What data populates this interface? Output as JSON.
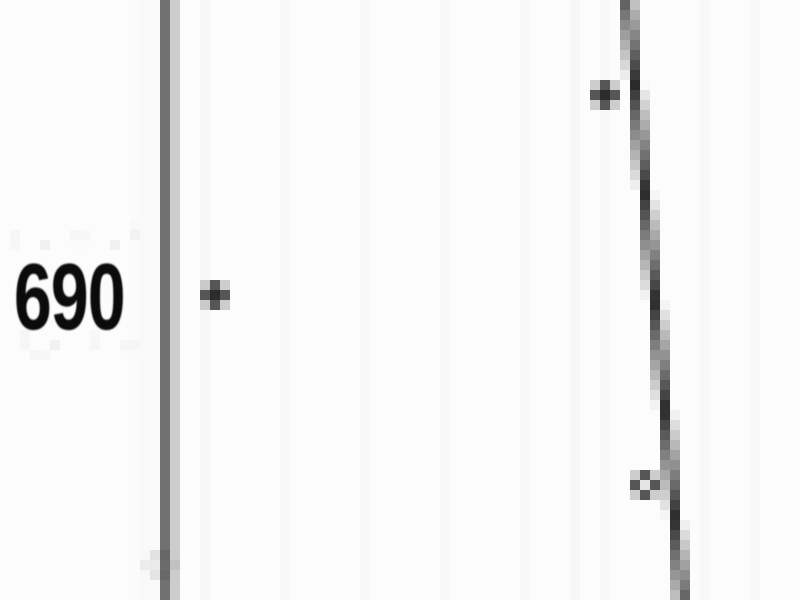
{
  "chart_data": {
    "type": "scatter",
    "background": "#fcfcfc",
    "y_axis": {
      "tick_labels": [
        "690"
      ],
      "tick_values": [
        690
      ],
      "axis_line_px": {
        "x": 168,
        "width": 8,
        "color": "#161616"
      }
    },
    "series": [
      {
        "name": "scatter-points",
        "marker": "plus",
        "color": "#565656",
        "points_px": [
          {
            "x": 215,
            "y": 295
          },
          {
            "x": 605,
            "y": 95
          },
          {
            "x": 645,
            "y": 485,
            "style": "open-center"
          }
        ]
      },
      {
        "name": "faint-axis-point",
        "marker": "open-circle",
        "color": "#c4c4c4",
        "points_px": [
          {
            "x": 160,
            "y": 565
          }
        ]
      }
    ],
    "trend_line_px": {
      "x1": 627,
      "y1": 0,
      "x2": 683,
      "y2": 600,
      "color": "#111111",
      "width": 9
    }
  }
}
